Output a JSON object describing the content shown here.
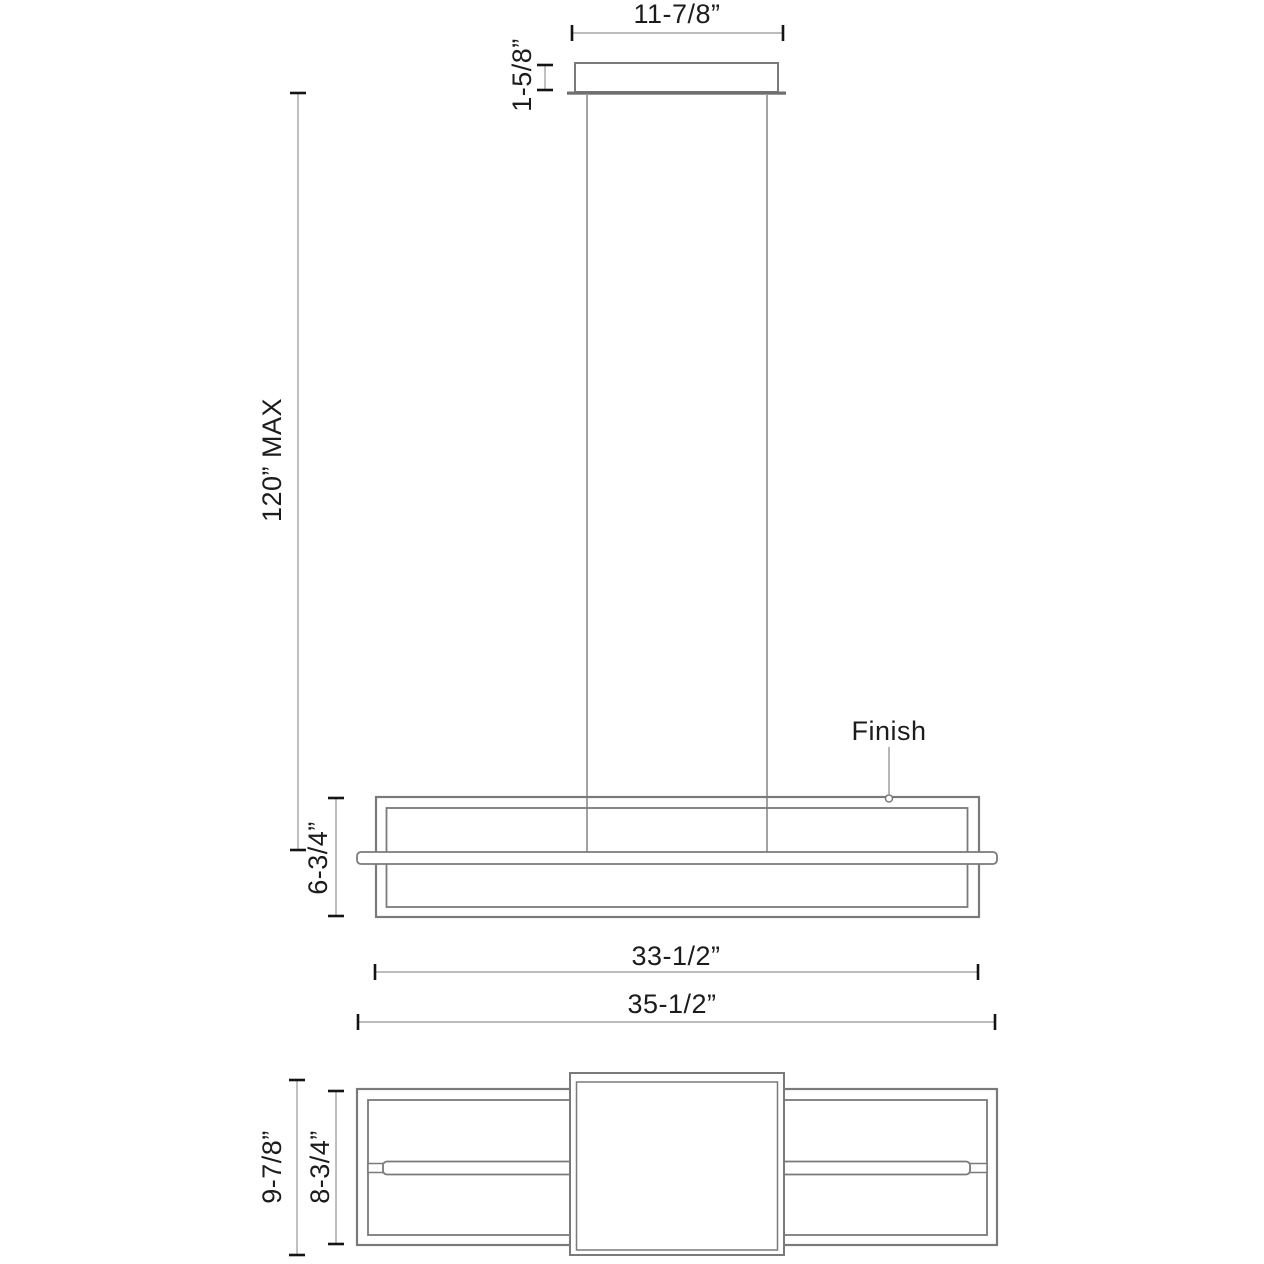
{
  "drawing": {
    "kind": "linear-pendant-fixture-dimension-diagram",
    "colors": {
      "background": "#ffffff",
      "object_line": "#7a7a7a",
      "dimension_line": "#a6a6a6",
      "tick": "#141414",
      "text": "#1c1c1c"
    },
    "front_view": {
      "canopy_width": "11-7/8”",
      "canopy_height": "1-5/8”",
      "max_suspension": "120” MAX",
      "fixture_height": "6-3/4”",
      "finish_label": "Finish",
      "frame_width": "33-1/2”",
      "overall_width": "35-1/2”"
    },
    "plan_view": {
      "overall_depth": "9-7/8”",
      "frame_depth": "8-3/4”"
    }
  }
}
